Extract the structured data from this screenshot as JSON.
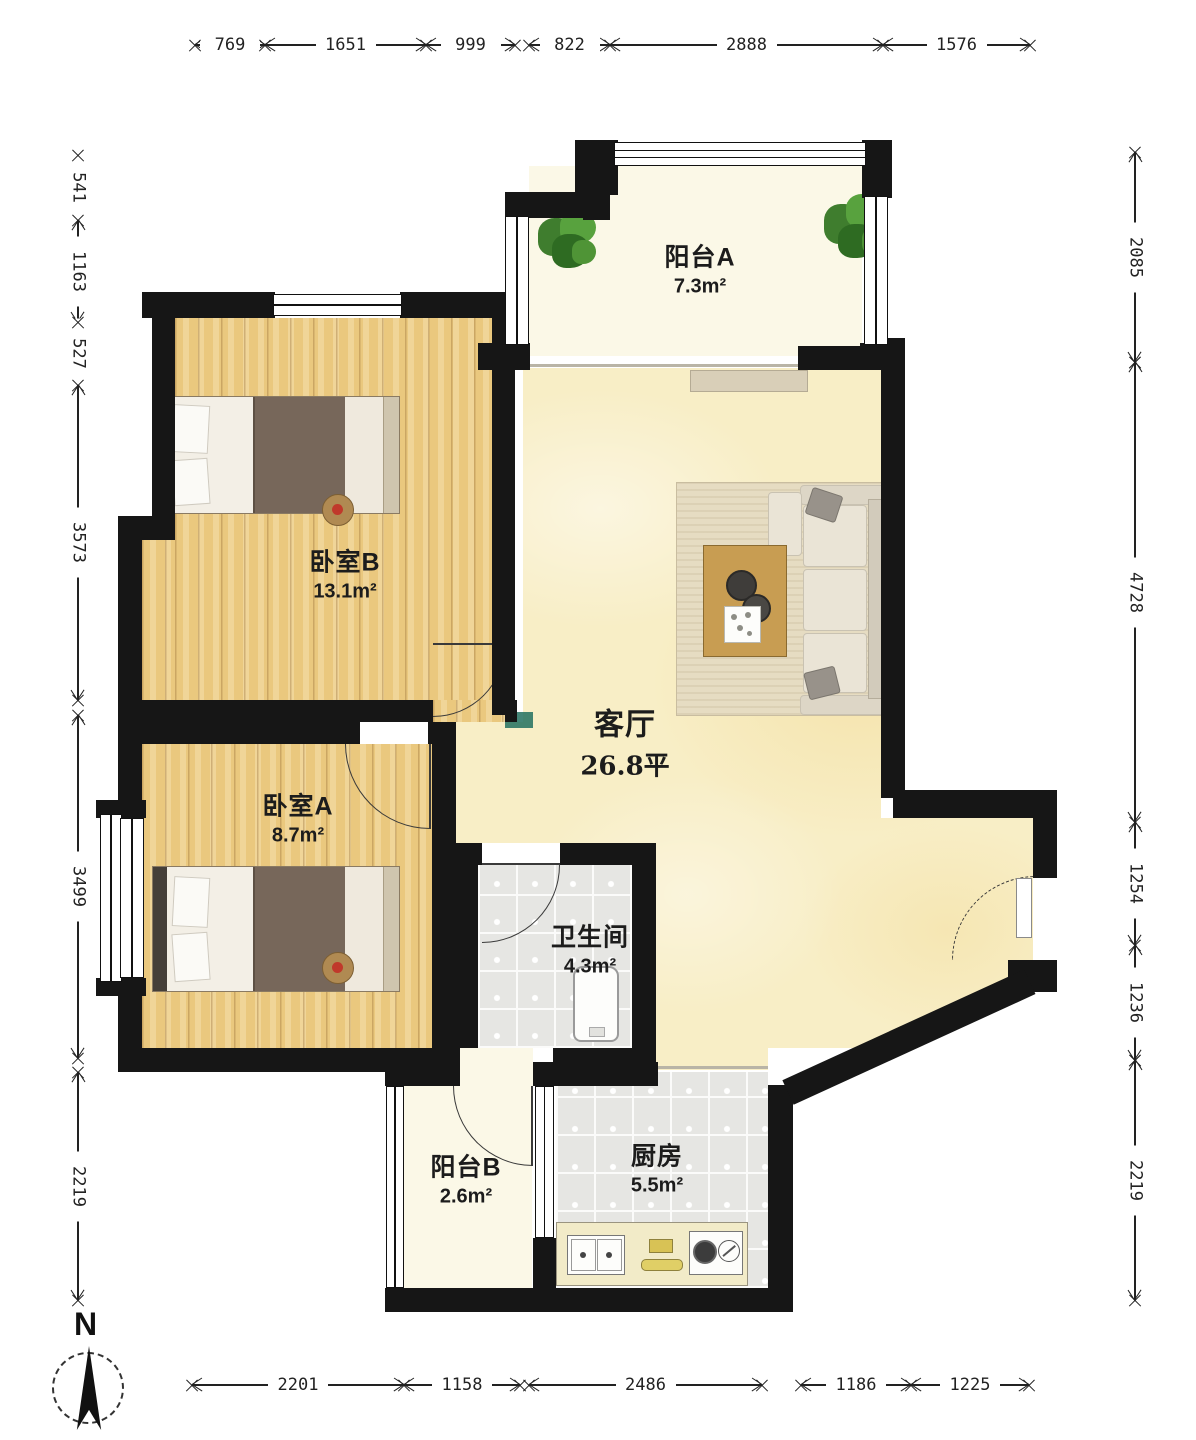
{
  "compass": {
    "label": "N"
  },
  "rooms": [
    {
      "id": "balcony-a",
      "name": "阳台A",
      "area": "7.3m²"
    },
    {
      "id": "bedroom-b",
      "name": "卧室B",
      "area": "13.1m²"
    },
    {
      "id": "living-room",
      "name": "客厅",
      "area": "26.8平"
    },
    {
      "id": "bedroom-a",
      "name": "卧室A",
      "area": "8.7m²"
    },
    {
      "id": "bathroom",
      "name": "卫生间",
      "area": "4.3m²"
    },
    {
      "id": "balcony-b",
      "name": "阳台B",
      "area": "2.6m²"
    },
    {
      "id": "kitchen",
      "name": "厨房",
      "area": "5.5m²"
    }
  ],
  "dimensions": {
    "top": {
      "pos": 45,
      "chains": [
        [
          {
            "label": "769",
            "from": 195,
            "to": 265
          },
          {
            "label": "1651",
            "from": 265,
            "to": 426
          },
          {
            "label": "999",
            "from": 426,
            "to": 515
          }
        ],
        [
          {
            "label": "822",
            "from": 529,
            "to": 610
          },
          {
            "label": "2888",
            "from": 610,
            "to": 883
          },
          {
            "label": "1576",
            "from": 883,
            "to": 1030
          }
        ]
      ]
    },
    "bottom": {
      "pos": 1385,
      "chains": [
        [
          {
            "label": "2201",
            "from": 192,
            "to": 404
          },
          {
            "label": "1158",
            "from": 404,
            "to": 520
          }
        ],
        [
          {
            "label": "2486",
            "from": 529,
            "to": 762
          }
        ],
        [
          {
            "label": "1186",
            "from": 801,
            "to": 911
          },
          {
            "label": "1225",
            "from": 911,
            "to": 1029
          }
        ]
      ]
    },
    "left": {
      "pos": 78,
      "chains": [
        [
          {
            "label": "541",
            "from": 155,
            "to": 220
          },
          {
            "label": "1163",
            "from": 220,
            "to": 322
          },
          {
            "label": "527",
            "from": 322,
            "to": 385
          },
          {
            "label": "3573",
            "from": 385,
            "to": 700
          }
        ],
        [
          {
            "label": "3499",
            "from": 715,
            "to": 1058
          }
        ],
        [
          {
            "label": "2219",
            "from": 1072,
            "to": 1300
          }
        ]
      ]
    },
    "right": {
      "pos": 1135,
      "chains": [
        [
          {
            "label": "2085",
            "from": 152,
            "to": 362
          }
        ],
        [
          {
            "label": "4728",
            "from": 362,
            "to": 822
          },
          {
            "label": "1254",
            "from": 822,
            "to": 945
          },
          {
            "label": "1236",
            "from": 945,
            "to": 1060
          }
        ],
        [
          {
            "label": "2219",
            "from": 1060,
            "to": 1300
          }
        ]
      ]
    }
  }
}
